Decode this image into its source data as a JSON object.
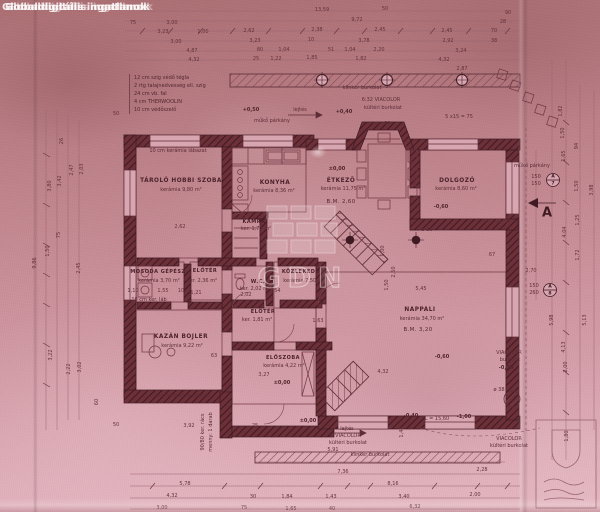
{
  "watermarks": {
    "corner": "Globaldigitális ingatlanok",
    "logo_text": "GDN"
  },
  "legend": {
    "items": [
      "12 cm szig védő tégla",
      "2 rtg talajnedvesség ell. szig",
      "24 cm vb. fal",
      "4 cm THERWOOLIN",
      "10 cm védőszelő"
    ]
  },
  "rooms": [
    {
      "name": "TÁROLÓ HOBBI SZOBA",
      "area": "kerámia 9,80 m²"
    },
    {
      "name": "KONYHA",
      "area": "kerámia 8,36 m²"
    },
    {
      "name": "ÉTKEZŐ",
      "area": "kerámia 11,75 m²",
      "bm": "B.M. 2,60"
    },
    {
      "name": "DOLGOZÓ",
      "area": "kerámia 8,60 m²"
    },
    {
      "name": "KAMRA",
      "area": "ker. 1,73 m²"
    },
    {
      "name": "ELŐTÉR",
      "area": "ker. 2,36 m²"
    },
    {
      "name": "W.C.",
      "area": "ker. 2,02 m²"
    },
    {
      "name": "KÖZLEKEDŐ",
      "area": "kerámia 7,50 m²"
    },
    {
      "name": "MOSODA GÉPÉSZ",
      "area": "kerámia 3,70 m²"
    },
    {
      "name": "ELŐTÉR",
      "area": "ker. 1,81 m²"
    },
    {
      "name": "KAZÁN BOJLER",
      "area": "kerámia 9,22 m²"
    },
    {
      "name": "ELŐSZOBA",
      "area": "kerámia 4,22 m²"
    },
    {
      "name": "NAPPALI",
      "area": "kerámia 34,70 m²",
      "bm": "B.M. 3,20"
    }
  ],
  "markers": {
    "window1": {
      "w": "A",
      "n": "7"
    },
    "window2": {
      "w": "A",
      "n": "8"
    },
    "section": "A"
  },
  "annotations": [
    {
      "t": "10 cm kerámia lábazat",
      "x": 178,
      "y": 151
    },
    {
      "t": "10 cm kerámia lábazat",
      "x": 182,
      "y": 396
    },
    {
      "t": "10 cm ker. láb",
      "x": 149,
      "y": 300
    },
    {
      "t": "klinker burkolat",
      "x": 362,
      "y": 88
    },
    {
      "t": "6:32 VIACOLOR",
      "x": 381,
      "y": 100
    },
    {
      "t": "kültéri burkolat",
      "x": 383,
      "y": 108
    },
    {
      "t": "lejtés",
      "x": 300,
      "y": 110
    },
    {
      "t": "műkő párkány",
      "x": 272,
      "y": 121
    },
    {
      "t": "p.m. 90",
      "x": 381,
      "y": 124
    },
    {
      "t": "műkő párkány",
      "x": 532,
      "y": 166
    },
    {
      "t": "ø 30",
      "x": 427,
      "y": 230
    },
    {
      "t": "VIACOLOR",
      "x": 509,
      "y": 353
    },
    {
      "t": "burkolat",
      "x": 510,
      "y": 360
    },
    {
      "t": "VIACOLOR",
      "x": 348,
      "y": 436
    },
    {
      "t": "kültéri burkolat",
      "x": 348,
      "y": 443
    },
    {
      "t": "klinker burkolat",
      "x": 370,
      "y": 455
    },
    {
      "t": "VIACOLOR",
      "x": 509,
      "y": 439
    },
    {
      "t": "kültéri burkolat",
      "x": 509,
      "y": 446
    },
    {
      "t": "lejtés",
      "x": 347,
      "y": 429
    },
    {
      "t": "L = 15,60",
      "x": 437,
      "y": 419
    },
    {
      "t": "ø 38",
      "x": 499,
      "y": 390
    },
    {
      "t": "90/80 ker. rács",
      "x": 203,
      "y": 432,
      "r": -90
    },
    {
      "t": "menny: 1 darab",
      "x": 211,
      "y": 432,
      "r": -90
    },
    {
      "t": "150",
      "x": 536,
      "y": 177
    },
    {
      "t": "150",
      "x": 536,
      "y": 184
    },
    {
      "t": "150",
      "x": 534,
      "y": 286
    },
    {
      "t": "260",
      "x": 534,
      "y": 293
    },
    {
      "t": "5 x15 = 75",
      "x": 459,
      "y": 117
    }
  ],
  "levels": [
    {
      "t": "±0,00",
      "x": 337,
      "y": 169
    },
    {
      "t": "+0,50",
      "x": 251,
      "y": 110
    },
    {
      "t": "+0,40",
      "x": 344,
      "y": 112
    },
    {
      "t": "-0,60",
      "x": 441,
      "y": 207
    },
    {
      "t": "-0,60",
      "x": 442,
      "y": 357
    },
    {
      "t": "-0,40",
      "x": 411,
      "y": 416
    },
    {
      "t": "-1,00",
      "x": 464,
      "y": 417
    },
    {
      "t": "-0,70",
      "x": 506,
      "y": 368
    },
    {
      "t": "±0,00",
      "x": 282,
      "y": 383
    },
    {
      "t": "±0,00",
      "x": 308,
      "y": 421
    }
  ],
  "dims": [
    {
      "t": "13,59",
      "x": 322,
      "y": 10
    },
    {
      "t": "9,72",
      "x": 357,
      "y": 20
    },
    {
      "t": "75",
      "x": 133,
      "y": 23
    },
    {
      "t": "3,00",
      "x": 172,
      "y": 23
    },
    {
      "t": "3,23",
      "x": 163,
      "y": 32
    },
    {
      "t": "1,00",
      "x": 203,
      "y": 32
    },
    {
      "t": "2,62",
      "x": 249,
      "y": 31
    },
    {
      "t": "2,38",
      "x": 317,
      "y": 30
    },
    {
      "t": "2,45",
      "x": 380,
      "y": 30
    },
    {
      "t": "2,45",
      "x": 447,
      "y": 31
    },
    {
      "t": "3,00",
      "x": 176,
      "y": 42
    },
    {
      "t": "3,23",
      "x": 255,
      "y": 41
    },
    {
      "t": "10",
      "x": 311,
      "y": 40
    },
    {
      "t": "3,78",
      "x": 364,
      "y": 41
    },
    {
      "t": "2,92",
      "x": 448,
      "y": 41
    },
    {
      "t": "4,87",
      "x": 192,
      "y": 51
    },
    {
      "t": "80",
      "x": 260,
      "y": 50
    },
    {
      "t": "1,04",
      "x": 284,
      "y": 50
    },
    {
      "t": "51",
      "x": 331,
      "y": 50
    },
    {
      "t": "1,04",
      "x": 350,
      "y": 50
    },
    {
      "t": "2,20",
      "x": 379,
      "y": 50
    },
    {
      "t": "3,24",
      "x": 461,
      "y": 51
    },
    {
      "t": "4,32",
      "x": 194,
      "y": 60
    },
    {
      "t": "25",
      "x": 256,
      "y": 59
    },
    {
      "t": "1,22",
      "x": 276,
      "y": 59
    },
    {
      "t": "1,85",
      "x": 312,
      "y": 58
    },
    {
      "t": "1,82",
      "x": 361,
      "y": 59
    },
    {
      "t": "4,32",
      "x": 444,
      "y": 60
    },
    {
      "t": "2,87",
      "x": 462,
      "y": 69
    },
    {
      "t": "90",
      "x": 508,
      "y": 13
    },
    {
      "t": "28",
      "x": 503,
      "y": 22
    },
    {
      "t": "70",
      "x": 494,
      "y": 31
    },
    {
      "t": "38",
      "x": 494,
      "y": 41
    },
    {
      "t": "50",
      "x": 385,
      "y": 9
    },
    {
      "t": "50",
      "x": 116,
      "y": 114
    },
    {
      "t": "9,86",
      "x": 35,
      "y": 263,
      "r": -90
    },
    {
      "t": "3,80",
      "x": 50,
      "y": 186,
      "r": -90
    },
    {
      "t": "3,42",
      "x": 60,
      "y": 181,
      "r": -90
    },
    {
      "t": "2,47",
      "x": 72,
      "y": 170,
      "r": -90
    },
    {
      "t": "2,03",
      "x": 82,
      "y": 169,
      "r": -90
    },
    {
      "t": "26",
      "x": 62,
      "y": 141,
      "r": -90
    },
    {
      "t": "75",
      "x": 59,
      "y": 235,
      "r": -90
    },
    {
      "t": "1,50",
      "x": 48,
      "y": 251,
      "r": -90
    },
    {
      "t": "2,45",
      "x": 79,
      "y": 268,
      "r": -90
    },
    {
      "t": "3,22",
      "x": 51,
      "y": 355,
      "r": -90
    },
    {
      "t": "2,22",
      "x": 69,
      "y": 369,
      "r": -90
    },
    {
      "t": "3,02",
      "x": 80,
      "y": 367,
      "r": -90
    },
    {
      "t": "60",
      "x": 97,
      "y": 402,
      "r": -90
    },
    {
      "t": "1,82",
      "x": 561,
      "y": 111,
      "r": -90
    },
    {
      "t": "1,50",
      "x": 563,
      "y": 133,
      "r": -90
    },
    {
      "t": "94",
      "x": 577,
      "y": 146,
      "r": -90
    },
    {
      "t": "1,65",
      "x": 564,
      "y": 156,
      "r": -90
    },
    {
      "t": "1,50",
      "x": 577,
      "y": 186,
      "r": -90
    },
    {
      "t": "3,98",
      "x": 592,
      "y": 190,
      "r": -90
    },
    {
      "t": "1,25",
      "x": 578,
      "y": 220,
      "r": -90
    },
    {
      "t": "4,04",
      "x": 565,
      "y": 232,
      "r": -90
    },
    {
      "t": "1,72",
      "x": 578,
      "y": 255,
      "r": -90
    },
    {
      "t": "5,98",
      "x": 552,
      "y": 320,
      "r": -90
    },
    {
      "t": "5,13",
      "x": 585,
      "y": 320,
      "r": -90
    },
    {
      "t": "4,13",
      "x": 564,
      "y": 347,
      "r": -90
    },
    {
      "t": "2,00",
      "x": 566,
      "y": 367,
      "r": -90
    },
    {
      "t": "1,80",
      "x": 567,
      "y": 436,
      "r": -90
    },
    {
      "t": "1,45",
      "x": 402,
      "y": 432,
      "r": -90
    },
    {
      "t": "2,50",
      "x": 394,
      "y": 272,
      "r": -90
    },
    {
      "t": "1,50",
      "x": 387,
      "y": 285,
      "r": -90
    },
    {
      "t": "1,00",
      "x": 383,
      "y": 251,
      "r": -90
    },
    {
      "t": "2,62",
      "x": 180,
      "y": 227
    },
    {
      "t": "1,10",
      "x": 133,
      "y": 291
    },
    {
      "t": "1,55",
      "x": 163,
      "y": 291
    },
    {
      "t": "10",
      "x": 181,
      "y": 291
    },
    {
      "t": "1,21",
      "x": 196,
      "y": 293
    },
    {
      "t": "2,02",
      "x": 246,
      "y": 295
    },
    {
      "t": "1,54",
      "x": 275,
      "y": 291
    },
    {
      "t": "1,63",
      "x": 318,
      "y": 321
    },
    {
      "t": "63",
      "x": 214,
      "y": 356
    },
    {
      "t": "3,27",
      "x": 264,
      "y": 375
    },
    {
      "t": "5,45",
      "x": 421,
      "y": 289
    },
    {
      "t": "4,32",
      "x": 383,
      "y": 372
    },
    {
      "t": "67",
      "x": 492,
      "y": 255
    },
    {
      "t": "38",
      "x": 508,
      "y": 255
    },
    {
      "t": "2,70",
      "x": 531,
      "y": 271
    },
    {
      "t": "32",
      "x": 488,
      "y": 222
    },
    {
      "t": "36",
      "x": 498,
      "y": 222
    },
    {
      "t": "35",
      "x": 508,
      "y": 222
    },
    {
      "t": "3,92",
      "x": 189,
      "y": 426
    },
    {
      "t": "50",
      "x": 116,
      "y": 425
    },
    {
      "t": "25",
      "x": 255,
      "y": 426
    },
    {
      "t": "7,36",
      "x": 343,
      "y": 472
    },
    {
      "t": "8,16",
      "x": 393,
      "y": 484
    },
    {
      "t": "5,78",
      "x": 185,
      "y": 484
    },
    {
      "t": "4,32",
      "x": 172,
      "y": 496
    },
    {
      "t": "30",
      "x": 253,
      "y": 497
    },
    {
      "t": "1,84",
      "x": 287,
      "y": 497
    },
    {
      "t": "1,43",
      "x": 331,
      "y": 497
    },
    {
      "t": "3,40",
      "x": 404,
      "y": 497
    },
    {
      "t": "3,00",
      "x": 162,
      "y": 508
    },
    {
      "t": "75",
      "x": 244,
      "y": 508
    },
    {
      "t": "1,65",
      "x": 291,
      "y": 509
    },
    {
      "t": "40",
      "x": 332,
      "y": 509
    },
    {
      "t": "6,32",
      "x": 415,
      "y": 507
    },
    {
      "t": "2,28",
      "x": 482,
      "y": 470
    },
    {
      "t": "2,00",
      "x": 475,
      "y": 495
    },
    {
      "t": "5,91",
      "x": 333,
      "y": 450
    }
  ]
}
